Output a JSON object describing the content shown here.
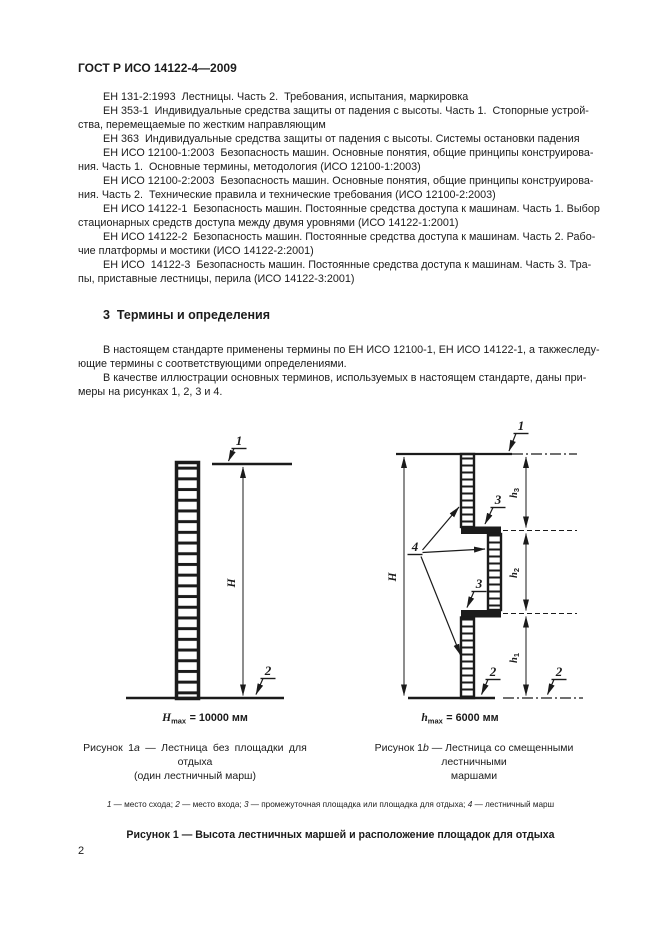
{
  "page": {
    "header": "ГОСТ Р ИСО 14122-4—2009",
    "page_number": "2"
  },
  "references": {
    "lines": [
      {
        "text": "ЕН 131-2:1993  Лестницы. Часть 2.  Требования, испытания, маркировка",
        "indent": true
      },
      {
        "text": "ЕН 353-1  Индивидуальные средства защиты от падения с высоты. Часть 1.  Стопорные устрой-",
        "indent": true
      },
      {
        "text": "ства, перемещаемые по жестким направляющим",
        "indent": false
      },
      {
        "text": "ЕН 363  Индивидуальные средства защиты от падения с высоты. Системы остановки падения",
        "indent": true
      },
      {
        "text": "ЕН ИСО 12100-1:2003  Безопасность машин. Основные понятия, общие принципы конструирова-",
        "indent": true
      },
      {
        "text": "ния. Часть 1.  Основные термины, методология (ИСО 12100-1:2003)",
        "indent": false
      },
      {
        "text": "ЕН ИСО 12100-2:2003  Безопасность машин. Основные понятия, общие принципы конструирова-",
        "indent": true
      },
      {
        "text": "ния. Часть 2.  Технические правила и технические требования (ИСО 12100-2:2003)",
        "indent": false
      },
      {
        "text": "ЕН ИСО 14122-1  Безопасность машин. Постоянные средства доступа к машинам. Часть 1. Выбор",
        "indent": true
      },
      {
        "text": "стационарных средств доступа между двумя уровнями (ИСО 14122-1:2001)",
        "indent": false
      },
      {
        "text": "ЕН ИСО 14122-2  Безопасность машин. Постоянные средства доступа к машинам. Часть 2. Рабо-",
        "indent": true
      },
      {
        "text": "чие платформы и мостики (ИСО 14122-2:2001)",
        "indent": false
      },
      {
        "text": "ЕН ИСО  14122-3  Безопасность машин. Постоянные средства доступа к машинам. Часть 3. Тра-",
        "indent": true
      },
      {
        "text": "пы, приставные лестницы, перила (ИСО 14122-3:2001)",
        "indent": false
      }
    ]
  },
  "section3": {
    "heading": "3  Термины и определения",
    "paragraph_lines": [
      {
        "text": "В настоящем стандарте применены термины по ЕН ИСО 12100-1, ЕН ИСО 14122-1, а такжеследу-",
        "indent": true
      },
      {
        "text": "ющие термины с соответствующими определениями.",
        "indent": false
      },
      {
        "text": "В качестве иллюстрации основных терминов, используемых в настоящем стандарте, даны при-",
        "indent": true
      },
      {
        "text": "меры на рисунках 1, 2, 3 и 4.",
        "indent": false
      }
    ]
  },
  "figures": {
    "fig1a": {
      "callout_top": "1",
      "callout_bottom": "2",
      "dim_label": "H",
      "formula_var": "H",
      "formula_sub": "max",
      "formula_rest": "= 10000 мм",
      "caption_prefix": "Рисунок 1",
      "caption_letter": "a",
      "caption_rest": " — Лестница без площадки для отдыха",
      "caption_line2": "(один лестничный марш)"
    },
    "fig1b": {
      "callout_top": "1",
      "callout_bottom_left": "2",
      "callout_bottom_right": "2",
      "callout_platform_top": "3",
      "callout_platform_bottom": "3",
      "callout_flights": "4",
      "dim_label": "H",
      "dim_h3_var": "h",
      "dim_h3_sub": "3",
      "dim_h2_var": "h",
      "dim_h2_sub": "2",
      "dim_h1_var": "h",
      "dim_h1_sub": "1",
      "formula_var": "h",
      "formula_sub": "max",
      "formula_rest": "= 6000 мм",
      "caption_prefix": "Рисунок 1",
      "caption_letter": "b",
      "caption_rest": " — Лестница со смещенными лестничными",
      "caption_line2": "маршами"
    },
    "legend_items": [
      {
        "num": "1",
        "text": " — место схода; "
      },
      {
        "num": "2",
        "text": " — место входа; "
      },
      {
        "num": "3",
        "text": " — промежуточная площадка или площадка для отдыха; "
      },
      {
        "num": "4",
        "text": " — лестничный марш"
      }
    ],
    "main_caption": "Рисунок 1 — Высота лестничных маршей и расположение площадок для отдыха"
  }
}
